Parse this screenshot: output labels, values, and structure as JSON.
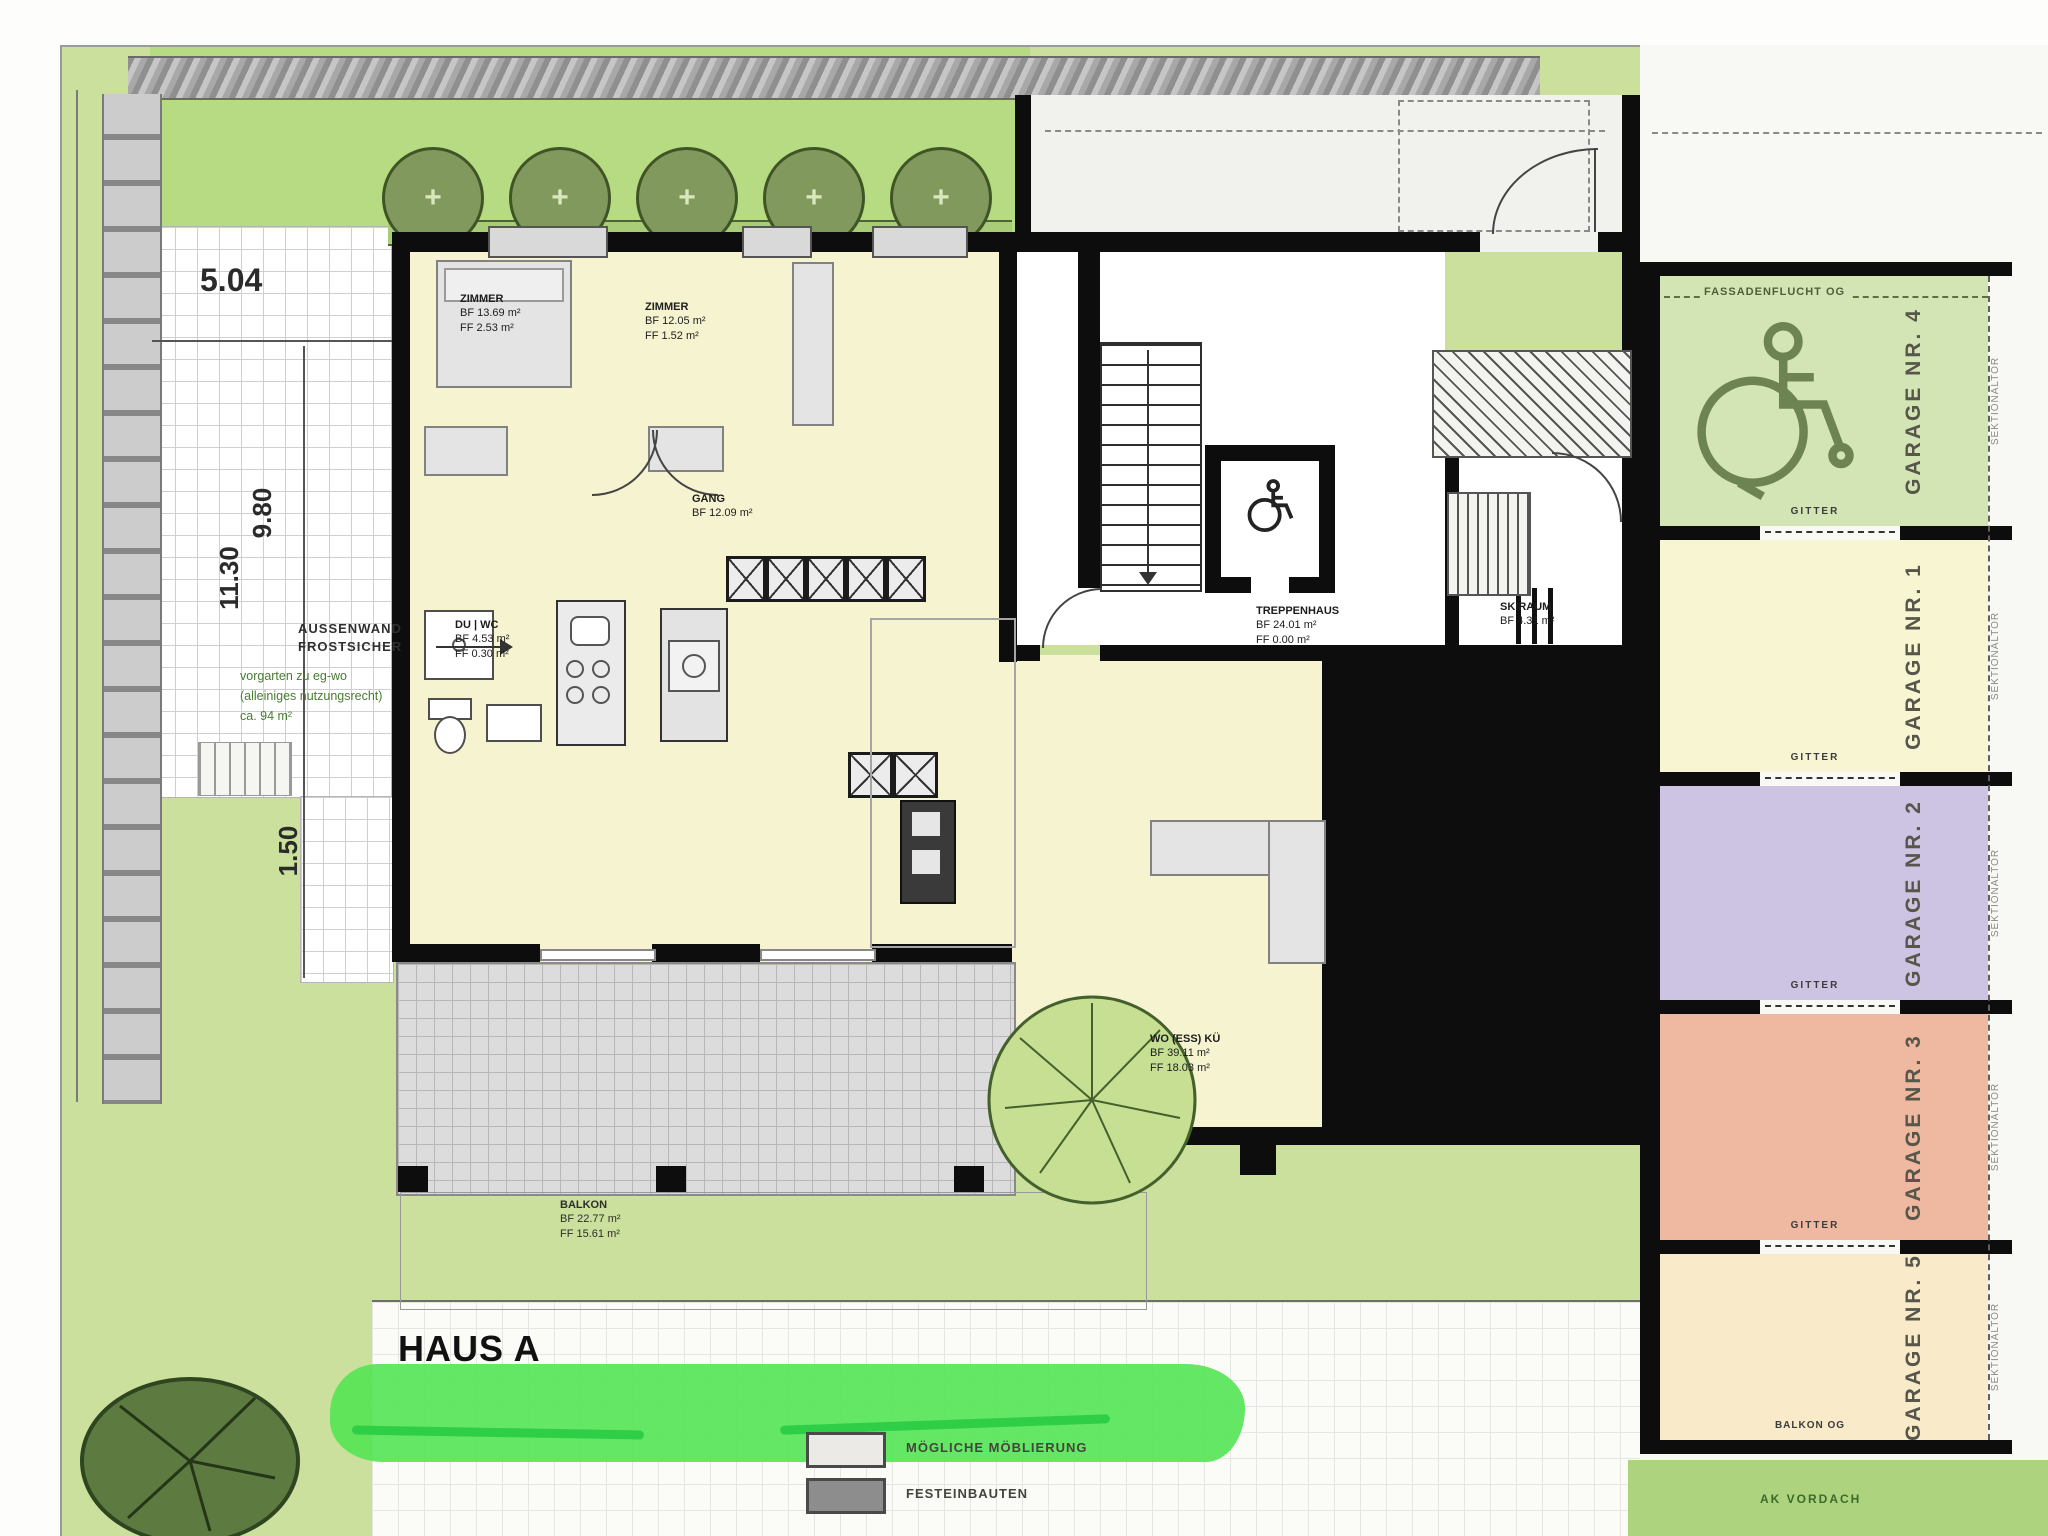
{
  "plan": {
    "title": "HAUS A",
    "rooms": {
      "zimmer1": {
        "name": "ZIMMER",
        "bf": "BF 13.69 m²",
        "ff": "FF 2.53 m²"
      },
      "zimmer2": {
        "name": "ZIMMER",
        "bf": "BF 12.05 m²",
        "ff": "FF 1.52 m²"
      },
      "duwc": {
        "name": "DU | WC",
        "bf": "BF 4.53 m²",
        "ff": "FF 0.30 m²"
      },
      "gang": {
        "name": "GANG",
        "bf": "BF 12.09 m²"
      },
      "treppenhaus": {
        "name": "TREPPENHAUS",
        "bf": "BF 24.01 m²",
        "ff": "FF 0.00 m²"
      },
      "skiraum": {
        "name": "SKIRAUM",
        "bf": "BF 4.31 m²"
      },
      "wohnen": {
        "name": "WO (ESS) KÜ",
        "bf": "BF 39.11 m²",
        "ff": "FF 18.03 m²"
      },
      "balkon": {
        "name": "BALKON",
        "bf": "BF 22.77 m²",
        "ff": "FF 15.61 m²"
      }
    },
    "garages": {
      "g4": {
        "label": "GARAGE NR. 4"
      },
      "g1": {
        "label": "GARAGE NR. 1"
      },
      "g2": {
        "label": "GARAGE NR. 2"
      },
      "g3": {
        "label": "GARAGE NR. 3"
      },
      "g5": {
        "label": "GARAGE NR. 5"
      }
    },
    "garage_annotations": {
      "fassadenflucht": "FASSADENFLUCHT OG",
      "gitter": "GITTER",
      "sektionaltor": "SEKTIONALTOR",
      "balkon_og": "BALKON OG",
      "ak_vordach": "AK VORDACH"
    },
    "dimensions": {
      "width_top": "5.04",
      "depth_a": "9.80",
      "depth_b": "11.30",
      "offset": "1.50"
    },
    "site_notes": {
      "aussenwand_1": "AUSSENWAND",
      "aussenwand_2": "FROSTSICHER",
      "vorgarten_1": "vorgarten zu eg-wo",
      "vorgarten_2": "(alleiniges nutzungsrecht)",
      "vorgarten_3": "ca. 94 m²"
    },
    "legend": {
      "item1": "MÖGLICHE MÖBLIERUNG",
      "item2": "FESTEINBAUTEN"
    }
  }
}
